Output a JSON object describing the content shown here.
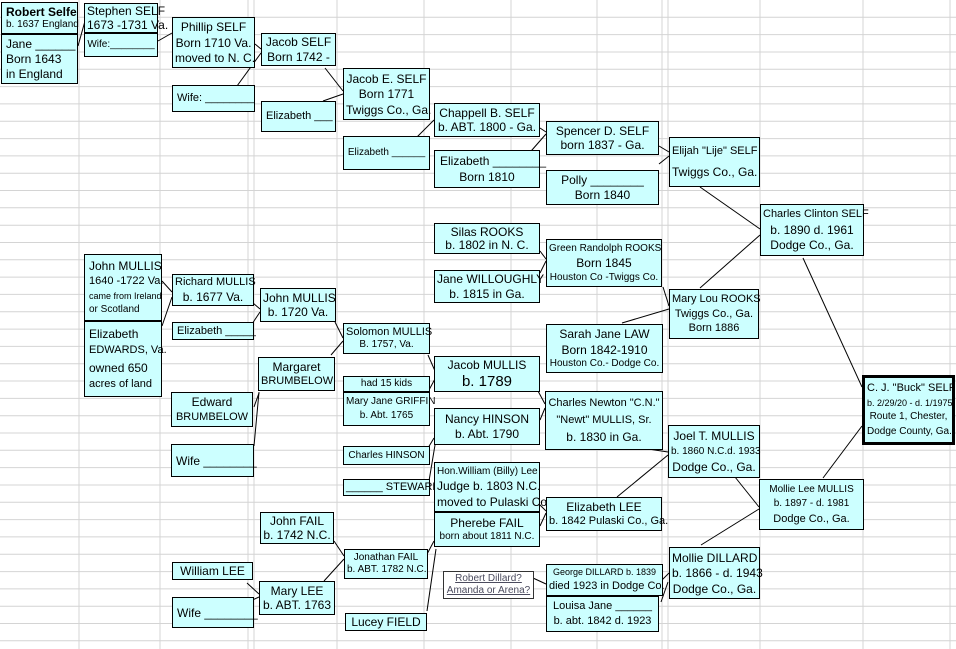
{
  "title": "SELF family genealogy tree",
  "colors": {
    "box_fill": "#CCFFFF",
    "box_border": "#000000",
    "grid_line": "#D4D4D4",
    "connector": "#000000",
    "note_text": "#4B4B5E",
    "background": "#FFFFFF"
  },
  "boxes": [
    {
      "id": "robert-selfe",
      "x": 1,
      "y": 2,
      "w": 77,
      "h": 32,
      "align": "l",
      "lines": [
        {
          "t": "Robert Selfe",
          "s": 12,
          "b": 1
        },
        {
          "t": "b. 1637 England",
          "s": 10
        }
      ]
    },
    {
      "id": "jane-blank",
      "x": 1,
      "y": 34,
      "w": 77,
      "h": 50,
      "align": "l",
      "lines": [
        {
          "t": "Jane ______",
          "s": 12
        },
        {
          "t": "Born 1643",
          "s": 12
        },
        {
          "t": "in England",
          "s": 12
        }
      ]
    },
    {
      "id": "stephen-self",
      "x": 84,
      "y": 3,
      "w": 74,
      "h": 30,
      "lines": [
        {
          "t": "Stephen SELF",
          "s": 12
        },
        {
          "t": "1673 -1731 Va.",
          "s": 12
        }
      ]
    },
    {
      "id": "stephen-wife",
      "x": 84,
      "y": 33,
      "w": 74,
      "h": 24,
      "lines": [
        {
          "t": "Wife:________",
          "s": 10
        }
      ]
    },
    {
      "id": "phillip-self",
      "x": 172,
      "y": 17,
      "w": 83,
      "h": 51,
      "lines": [
        {
          "t": "Phillip SELF",
          "s": 12
        },
        {
          "t": "Born 1710  Va.",
          "s": 12
        },
        {
          "t": "moved to N. C.",
          "s": 12
        }
      ]
    },
    {
      "id": "phillip-wife",
      "x": 172,
      "y": 85,
      "w": 83,
      "h": 27,
      "align": "l",
      "lines": [
        {
          "t": "Wife: ________",
          "s": 11
        }
      ]
    },
    {
      "id": "jacob-self",
      "x": 261,
      "y": 33,
      "w": 75,
      "h": 33,
      "lines": [
        {
          "t": "Jacob SELF",
          "s": 12
        },
        {
          "t": "Born 1742 -",
          "s": 12
        }
      ]
    },
    {
      "id": "jacob-wife-elizabeth",
      "x": 261,
      "y": 101,
      "w": 75,
      "h": 31,
      "align": "l",
      "lines": [
        {
          "t": "Elizabeth ___",
          "s": 11
        }
      ]
    },
    {
      "id": "jacob-e-self",
      "x": 343,
      "y": 68,
      "w": 87,
      "h": 52,
      "lines": [
        {
          "t": "Jacob E. SELF",
          "s": 12
        },
        {
          "t": "Born 1771",
          "s": 12
        },
        {
          "t": "Twiggs Co., Ga.",
          "s": 12
        }
      ]
    },
    {
      "id": "jacob-e-wife-elizabeth",
      "x": 343,
      "y": 136,
      "w": 87,
      "h": 34,
      "lines": [
        {
          "t": "Elizabeth ______",
          "s": 10
        }
      ]
    },
    {
      "id": "chappell-b-self",
      "x": 434,
      "y": 103,
      "w": 106,
      "h": 34,
      "lines": [
        {
          "t": "Chappell B. SELF",
          "s": 12
        },
        {
          "t": "b. ABT. 1800 - Ga.",
          "s": 12
        }
      ]
    },
    {
      "id": "chappell-wife-elizabeth",
      "x": 434,
      "y": 150,
      "w": 106,
      "h": 38,
      "lines": [
        {
          "t": "Elizabeth ________",
          "s": 12,
          "a": "l"
        },
        {
          "t": "Born 1810",
          "s": 12
        }
      ]
    },
    {
      "id": "spencer-d-self",
      "x": 546,
      "y": 121,
      "w": 113,
      "h": 34,
      "lines": [
        {
          "t": "Spencer D. SELF",
          "s": 12
        },
        {
          "t": "born 1837 - Ga.",
          "s": 12
        }
      ]
    },
    {
      "id": "polly",
      "x": 546,
      "y": 170,
      "w": 113,
      "h": 35,
      "lines": [
        {
          "t": "Polly ________",
          "s": 12
        },
        {
          "t": "Born 1840",
          "s": 12
        }
      ]
    },
    {
      "id": "elijah-self",
      "x": 669,
      "y": 137,
      "w": 91,
      "h": 50,
      "lines": [
        {
          "t": "Elijah \"Lije\" SELF",
          "s": 11
        },
        {
          "t": "Twiggs Co., Ga.",
          "s": 12
        }
      ]
    },
    {
      "id": "charles-clinton-self",
      "x": 760,
      "y": 204,
      "w": 104,
      "h": 52,
      "lines": [
        {
          "t": "Charles Clinton SELF",
          "s": 11
        },
        {
          "t": "b. 1890 d. 1961",
          "s": 12
        },
        {
          "t": "Dodge Co., Ga.",
          "s": 12
        }
      ]
    },
    {
      "id": "silas-rooks",
      "x": 434,
      "y": 223,
      "w": 106,
      "h": 31,
      "lines": [
        {
          "t": "Silas ROOKS",
          "s": 12
        },
        {
          "t": "b. 1802  in N. C.",
          "s": 12
        }
      ]
    },
    {
      "id": "jane-willoughly",
      "x": 434,
      "y": 270,
      "w": 106,
      "h": 33,
      "lines": [
        {
          "t": "Jane WILLOUGHLY",
          "s": 12
        },
        {
          "t": "b. 1815 in Ga.",
          "s": 12
        }
      ]
    },
    {
      "id": "green-randolph-rooks",
      "x": 546,
      "y": 239,
      "w": 116,
      "h": 48,
      "lines": [
        {
          "t": "Green Randolph ROOKS",
          "s": 10
        },
        {
          "t": "Born 1845",
          "s": 12
        },
        {
          "t": "Houston Co -Twiggs Co.",
          "s": 10
        }
      ]
    },
    {
      "id": "mary-lou-rooks",
      "x": 669,
      "y": 289,
      "w": 90,
      "h": 50,
      "lines": [
        {
          "t": "Mary Lou ROOKS",
          "s": 11
        },
        {
          "t": "Twiggs Co., Ga.",
          "s": 11
        },
        {
          "t": "Born 1886",
          "s": 11
        }
      ]
    },
    {
      "id": "sarah-jane-law",
      "x": 546,
      "y": 324,
      "w": 117,
      "h": 49,
      "lines": [
        {
          "t": "Sarah Jane LAW",
          "s": 12
        },
        {
          "t": "Born 1842-1910",
          "s": 12
        },
        {
          "t": "Houston Co.- Dodge Co.",
          "s": 10
        }
      ]
    },
    {
      "id": "solomon-mullis",
      "x": 343,
      "y": 323,
      "w": 87,
      "h": 31,
      "lines": [
        {
          "t": "Solomon  MULLIS",
          "s": 11
        },
        {
          "t": "B. 1757, Va.",
          "s": 10
        }
      ]
    },
    {
      "id": "had-15-kids",
      "x": 343,
      "y": 376,
      "w": 87,
      "h": 16,
      "lines": [
        {
          "t": "had 15 kids",
          "s": 10
        }
      ]
    },
    {
      "id": "mary-jane-griffin",
      "x": 343,
      "y": 392,
      "w": 87,
      "h": 34,
      "lines": [
        {
          "t": "Mary Jane GRIFFIN",
          "s": 10
        },
        {
          "t": "b. Abt. 1765",
          "s": 10
        }
      ]
    },
    {
      "id": "jacob-mullis",
      "x": 434,
      "y": 356,
      "w": 106,
      "h": 36,
      "lines": [
        {
          "t": "Jacob MULLIS",
          "s": 12
        },
        {
          "t": "b. 1789",
          "s": 15
        }
      ]
    },
    {
      "id": "nancy-hinson",
      "x": 434,
      "y": 408,
      "w": 106,
      "h": 37,
      "lines": [
        {
          "t": "Nancy HINSON",
          "s": 12
        },
        {
          "t": "b. Abt. 1790",
          "s": 12
        }
      ]
    },
    {
      "id": "charles-hinson",
      "x": 343,
      "y": 446,
      "w": 87,
      "h": 19,
      "lines": [
        {
          "t": "Charles HINSON",
          "s": 10
        }
      ]
    },
    {
      "id": "steward",
      "x": 343,
      "y": 479,
      "w": 87,
      "h": 17,
      "lines": [
        {
          "t": "______ STEWARD",
          "s": 11
        }
      ]
    },
    {
      "id": "charles-newton-mullis",
      "x": 545,
      "y": 391,
      "w": 118,
      "h": 59,
      "lines": [
        {
          "t": "Charles Newton \"C.N.\"",
          "s": 11
        },
        {
          "t": "\"Newt\"  MULLIS, Sr.",
          "s": 11
        },
        {
          "t": "b. 1830 in Ga.",
          "s": 12
        }
      ]
    },
    {
      "id": "hon-william-lee",
      "x": 434,
      "y": 462,
      "w": 106,
      "h": 50,
      "lines": [
        {
          "t": "Hon.William (Billy) Lee",
          "s": 10
        },
        {
          "t": "Judge b. 1803 N.C.",
          "s": 12
        },
        {
          "t": "moved to Pulaski Co.",
          "s": 12
        }
      ]
    },
    {
      "id": "pherebe-fail",
      "x": 434,
      "y": 512,
      "w": 106,
      "h": 35,
      "lines": [
        {
          "t": "Pherebe FAIL",
          "s": 12
        },
        {
          "t": "born about 1811 N.C.",
          "s": 10
        }
      ]
    },
    {
      "id": "elizabeth-lee",
      "x": 546,
      "y": 497,
      "w": 116,
      "h": 34,
      "lines": [
        {
          "t": "Elizabeth LEE",
          "s": 12
        },
        {
          "t": "b. 1842 Pulaski Co., Ga.",
          "s": 11
        }
      ]
    },
    {
      "id": "joel-t-mullis",
      "x": 668,
      "y": 425,
      "w": 92,
      "h": 53,
      "lines": [
        {
          "t": "Joel T. MULLIS",
          "s": 12
        },
        {
          "t": "b. 1860 N.C.d. 1933",
          "s": 10
        },
        {
          "t": "Dodge Co., Ga.",
          "s": 12
        }
      ]
    },
    {
      "id": "mollie-lee-mullis",
      "x": 759,
      "y": 479,
      "w": 105,
      "h": 51,
      "lines": [
        {
          "t": "Mollie Lee MULLIS",
          "s": 10
        },
        {
          "t": "b. 1897 - d. 1981",
          "s": 10
        },
        {
          "t": "Dodge Co., Ga.",
          "s": 11
        }
      ]
    },
    {
      "id": "cj-buck-self",
      "x": 862,
      "y": 375,
      "w": 93,
      "h": 70,
      "variant": "thick",
      "lines": [
        {
          "t": "C. J.  \"Buck\" SELF",
          "s": 11
        },
        {
          "t": "b. 2/29/20 - d. 1/1975",
          "s": 9
        },
        {
          "t": "Route 1, Chester,",
          "s": 10
        },
        {
          "t": "Dodge County, Ga.",
          "s": 10
        }
      ]
    },
    {
      "id": "john-mullis-1640",
      "x": 84,
      "y": 254,
      "w": 78,
      "h": 67,
      "align": "l",
      "lines": [
        {
          "t": "John MULLIS",
          "s": 12
        },
        {
          "t": "1640 -1722 Va.",
          "s": 11
        },
        {
          "t": "came from Ireland",
          "s": 9
        },
        {
          "t": "or Scotland",
          "s": 10
        }
      ]
    },
    {
      "id": "elizabeth-edwards",
      "x": 84,
      "y": 321,
      "w": 78,
      "h": 76,
      "align": "l",
      "lines": [
        {
          "t": "Elizabeth",
          "s": 12
        },
        {
          "t": "EDWARDS, Va.",
          "s": 11
        },
        {
          "t": "owned 650",
          "s": 12
        },
        {
          "t": "acres of land",
          "s": 11
        }
      ]
    },
    {
      "id": "richard-mullis",
      "x": 172,
      "y": 274,
      "w": 82,
      "h": 32,
      "lines": [
        {
          "t": "Richard MULLIS",
          "s": 11
        },
        {
          "t": "b. 1677 Va.",
          "s": 12
        }
      ]
    },
    {
      "id": "richard-wife-elizabeth",
      "x": 172,
      "y": 322,
      "w": 82,
      "h": 18,
      "align": "l",
      "lines": [
        {
          "t": "Elizabeth _____",
          "s": 11
        }
      ]
    },
    {
      "id": "john-mullis-1720",
      "x": 260,
      "y": 288,
      "w": 76,
      "h": 34,
      "lines": [
        {
          "t": "John MULLIS",
          "s": 12
        },
        {
          "t": "b. 1720 Va.",
          "s": 12
        }
      ]
    },
    {
      "id": "margaret-brumbelow",
      "x": 258,
      "y": 357,
      "w": 77,
      "h": 34,
      "lines": [
        {
          "t": "Margaret",
          "s": 12
        },
        {
          "t": "BRUMBELOW",
          "s": 11
        }
      ]
    },
    {
      "id": "edward-brumbelow",
      "x": 171,
      "y": 392,
      "w": 82,
      "h": 35,
      "lines": [
        {
          "t": "Edward",
          "s": 12
        },
        {
          "t": "BRUMBELOW",
          "s": 11
        }
      ]
    },
    {
      "id": "edward-wife",
      "x": 171,
      "y": 444,
      "w": 83,
      "h": 33,
      "align": "l",
      "lines": [
        {
          "t": "Wife ________",
          "s": 12
        }
      ]
    },
    {
      "id": "john-fail",
      "x": 260,
      "y": 512,
      "w": 74,
      "h": 32,
      "lines": [
        {
          "t": "John FAIL",
          "s": 12
        },
        {
          "t": "b. 1742 N.C.",
          "s": 12
        }
      ]
    },
    {
      "id": "william-lee",
      "x": 172,
      "y": 562,
      "w": 81,
      "h": 18,
      "lines": [
        {
          "t": "William LEE",
          "s": 12
        }
      ]
    },
    {
      "id": "william-wife",
      "x": 172,
      "y": 597,
      "w": 82,
      "h": 31,
      "align": "l",
      "lines": [
        {
          "t": "Wife ________",
          "s": 12
        }
      ]
    },
    {
      "id": "mary-lee",
      "x": 259,
      "y": 581,
      "w": 76,
      "h": 34,
      "lines": [
        {
          "t": "Mary LEE",
          "s": 12
        },
        {
          "t": "b. ABT. 1763",
          "s": 12
        }
      ]
    },
    {
      "id": "jonathan-fail",
      "x": 344,
      "y": 549,
      "w": 84,
      "h": 30,
      "lines": [
        {
          "t": "Jonathan FAIL",
          "s": 10
        },
        {
          "t": "b. ABT. 1782 N.C.",
          "s": 10
        }
      ]
    },
    {
      "id": "lucey-field",
      "x": 345,
      "y": 613,
      "w": 82,
      "h": 18,
      "lines": [
        {
          "t": "Lucey FIELD",
          "s": 12
        }
      ]
    },
    {
      "id": "robert-dillard-note",
      "x": 443,
      "y": 571,
      "w": 91,
      "h": 28,
      "variant": "white",
      "lines": [
        {
          "t": "Robert Dillard?",
          "s": 10,
          "u": 1
        },
        {
          "t": "Amanda or Arena?",
          "s": 10,
          "u": 1
        }
      ]
    },
    {
      "id": "george-dillard",
      "x": 546,
      "y": 564,
      "w": 117,
      "h": 32,
      "lines": [
        {
          "t": "George DILLARD b. 1839",
          "s": 9
        },
        {
          "t": "died 1923 in Dodge Co.",
          "s": 11
        }
      ]
    },
    {
      "id": "louisa-jane",
      "x": 546,
      "y": 596,
      "w": 113,
      "h": 36,
      "lines": [
        {
          "t": "Louisa Jane ______",
          "s": 11
        },
        {
          "t": "b. abt. 1842 d. 1923",
          "s": 11
        }
      ]
    },
    {
      "id": "mollie-dillard",
      "x": 669,
      "y": 547,
      "w": 91,
      "h": 52,
      "lines": [
        {
          "t": "Mollie DILLARD",
          "s": 12
        },
        {
          "t": "b. 1866 - d. 1943",
          "s": 12
        },
        {
          "t": "Dodge Co., Ga.",
          "s": 12
        }
      ]
    }
  ],
  "connectors": [
    [
      78,
      46,
      85,
      21
    ],
    [
      158,
      41,
      172,
      33
    ],
    [
      255,
      44,
      261,
      49
    ],
    [
      237,
      86,
      261,
      53
    ],
    [
      325,
      68,
      343,
      91
    ],
    [
      323,
      101,
      343,
      94
    ],
    [
      415,
      139,
      434,
      120
    ],
    [
      540,
      128,
      546,
      132
    ],
    [
      525,
      158,
      546,
      134
    ],
    [
      659,
      146,
      669,
      152
    ],
    [
      659,
      164,
      669,
      156
    ],
    [
      700,
      187,
      760,
      229
    ],
    [
      700,
      288,
      760,
      235
    ],
    [
      803,
      258,
      862,
      387
    ],
    [
      823,
      478,
      862,
      426
    ],
    [
      540,
      251,
      546,
      259
    ],
    [
      540,
      273,
      546,
      261
    ],
    [
      663,
      287,
      669,
      306
    ],
    [
      622,
      323,
      669,
      309
    ],
    [
      428,
      355,
      435,
      371
    ],
    [
      429,
      390,
      436,
      377
    ],
    [
      538,
      391,
      545,
      404
    ],
    [
      540,
      420,
      545,
      408
    ],
    [
      428,
      448,
      434,
      438
    ],
    [
      429,
      481,
      435,
      445
    ],
    [
      538,
      503,
      546,
      511
    ],
    [
      540,
      526,
      546,
      513
    ],
    [
      426,
      556,
      434,
      541
    ],
    [
      427,
      611,
      436,
      549
    ],
    [
      334,
      541,
      344,
      556
    ],
    [
      324,
      581,
      344,
      559
    ],
    [
      247,
      583,
      259,
      594
    ],
    [
      248,
      602,
      259,
      597
    ],
    [
      662,
      580,
      669,
      573
    ],
    [
      661,
      602,
      668,
      582
    ],
    [
      533,
      578,
      546,
      584
    ],
    [
      635,
      447,
      668,
      452
    ],
    [
      617,
      497,
      668,
      455
    ],
    [
      735,
      477,
      759,
      507
    ],
    [
      701,
      545,
      759,
      509
    ],
    [
      162,
      281,
      172,
      292
    ],
    [
      162,
      326,
      172,
      297
    ],
    [
      253,
      303,
      260,
      309
    ],
    [
      252,
      324,
      260,
      312
    ],
    [
      335,
      322,
      343,
      338
    ],
    [
      331,
      355,
      343,
      341
    ],
    [
      254,
      407,
      259,
      393
    ],
    [
      254,
      446,
      259,
      392
    ]
  ]
}
